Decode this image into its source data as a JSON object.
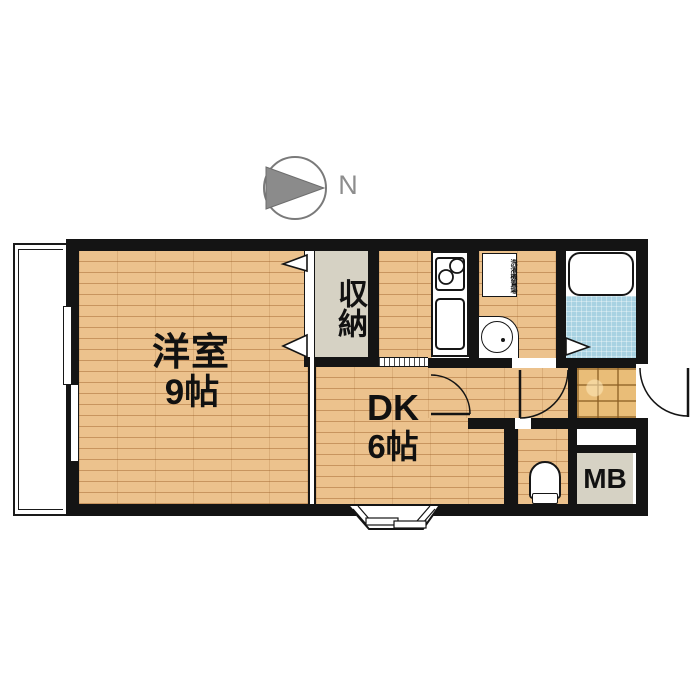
{
  "compass": {
    "label": "N"
  },
  "rooms": {
    "western_room": {
      "name": "洋室",
      "size": "9帖"
    },
    "dining_kitchen": {
      "name": "DK",
      "size": "6帖"
    },
    "closet": {
      "label": "収納"
    },
    "meter_box": {
      "label": "MB"
    },
    "washer_space": {
      "label": "洗濯機置場"
    }
  },
  "colors": {
    "wood": "#ecc28d",
    "closet_gray": "#d6d2c4",
    "bath_blue": "#a8d2e2",
    "tile": "#e9bd78",
    "wall": "#141414",
    "compass_gray": "#8b8b8b"
  }
}
